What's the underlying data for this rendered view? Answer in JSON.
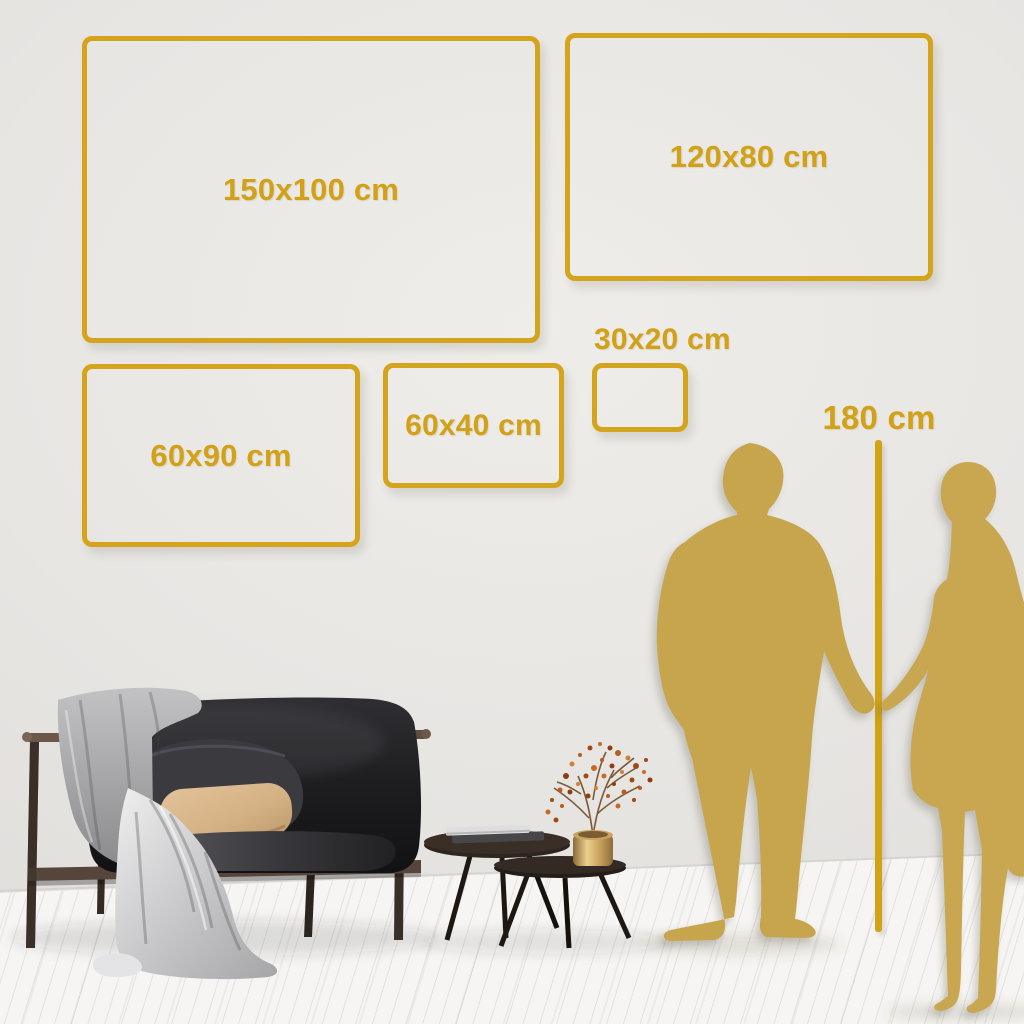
{
  "title": "Wall art size comparison guide",
  "colors": {
    "frame_gold": "#d5a41d",
    "label_gold": "#d2a118",
    "silhouette_gold": "#c7a54d",
    "wall": "#e8e6e3",
    "floor": "#f5f4f2"
  },
  "size_guide": {
    "unit": "cm",
    "frames": [
      {
        "label": "150x100 cm",
        "width_cm": 150,
        "height_cm": 100
      },
      {
        "label": "120x80 cm",
        "width_cm": 120,
        "height_cm": 80
      },
      {
        "label": "60x90 cm",
        "width_cm": 60,
        "height_cm": 90
      },
      {
        "label": "60x40 cm",
        "width_cm": 60,
        "height_cm": 40
      },
      {
        "label": "30x20 cm",
        "width_cm": 30,
        "height_cm": 20
      }
    ],
    "height_marker": {
      "label": "180 cm",
      "height_cm": 180
    }
  },
  "scene": {
    "figures": [
      "man-silhouette",
      "woman-silhouette-holding-hands"
    ],
    "furniture": [
      "dark-velvet-loveseat",
      "gray-throw-blanket",
      "beige-pillow",
      "round-nesting-coffee-tables",
      "books",
      "brass-vase-with-berry-branch"
    ]
  }
}
